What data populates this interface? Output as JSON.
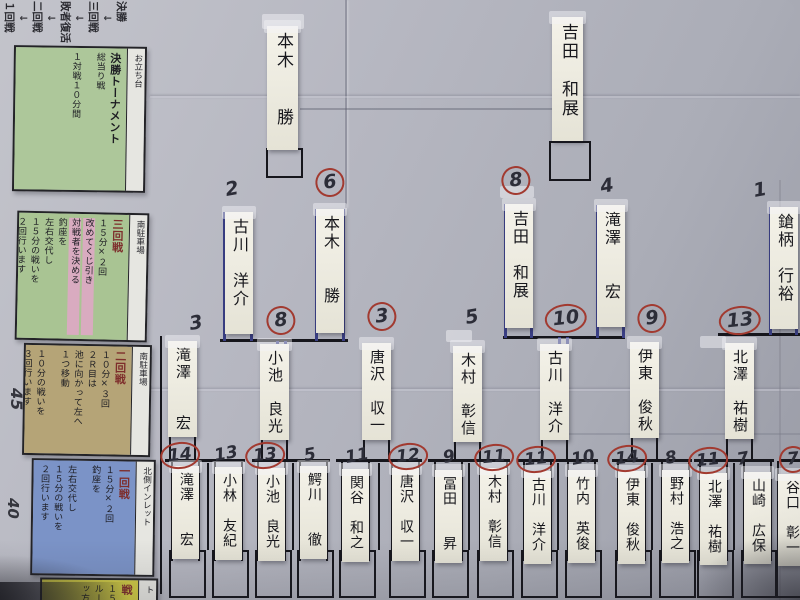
{
  "board": {
    "progression": [
      "１回戦",
      "↓",
      "二回戦",
      "↓",
      "敗者復活",
      "↓",
      "三回戦",
      "↓",
      "決勝"
    ],
    "margin": {
      "top_number": "45",
      "bottom_number": "40",
      "label": "基本進行"
    },
    "colors": {
      "riser_blue": "#3a3f85",
      "circle_red": "#a23a30",
      "legend_final": "#adc79a",
      "legend_round3": "#a9c493",
      "legend_round3_highlight": "#d9abc0",
      "legend_round2": "#b5a477",
      "legend_round1": "#7b93c7",
      "legend_bottom": "#cfca45"
    },
    "legend": [
      {
        "title": "決勝トーナメント",
        "lines": [
          "総当り戦",
          "",
          "１対戦１０分間"
        ],
        "location": "お立ち台",
        "color": "#adc79a",
        "highlight": []
      },
      {
        "title": "三回戦",
        "lines": [
          "１５分×２回",
          "改めてくじ引き",
          "対戦者を決める",
          "釣座を",
          "左右交代し",
          "１５分の戦いを",
          "２回行います"
        ],
        "location": "南駐車場",
        "color": "#a9c493",
        "highlight": [
          1,
          2
        ]
      },
      {
        "title": "二回戦",
        "lines": [
          "１０分×３回",
          "２Ｒ目は",
          "池に向かって左へ",
          "１つ移動",
          "",
          "１０分の戦いを",
          "３回行います"
        ],
        "location": "南駐車場",
        "color": "#b5a477",
        "highlight": []
      },
      {
        "title": "一回戦",
        "lines": [
          "１５分×２回",
          "釣座を",
          "",
          "左右交代し",
          "１５分の戦いを",
          "２回行います"
        ],
        "location": "北側インレット",
        "color": "#7b93c7",
        "highlight": []
      },
      {
        "title": "戦",
        "lines": [
          "１５分×２回",
          "ルー",
          "ッ方け"
        ],
        "location": "ト",
        "color": "#cfca45",
        "highlight": []
      }
    ],
    "rounds": {
      "final": [
        {
          "name": "本木　　勝"
        },
        {
          "name": "吉田　和展"
        }
      ],
      "semifinal": [
        {
          "name": "古川　洋介",
          "score": "2",
          "circled": false
        },
        {
          "name": "本木　　勝",
          "score": "6",
          "circled": true
        },
        {
          "name": "吉田　和展",
          "score": "8",
          "circled": true
        },
        {
          "name": "滝澤　　宏",
          "score": "4",
          "circled": false
        },
        {
          "name": "鎗柄　行裕",
          "score": "1",
          "circled": false
        }
      ],
      "quarterfinal": [
        {
          "name": "滝澤　　宏",
          "score": "3",
          "circled": false
        },
        {
          "name": "小池　良光",
          "score": "8",
          "circled": true
        },
        {
          "name": "唐沢　収一",
          "score": "3",
          "circled": true
        },
        {
          "name": "木村　彰信",
          "score": "5",
          "circled": false
        },
        {
          "name": "古川　洋介",
          "score": "10",
          "circled": true
        },
        {
          "name": "伊東　俊秋",
          "score": "9",
          "circled": true
        },
        {
          "name": "北澤　祐樹",
          "score": "13",
          "circled": true
        }
      ],
      "round1": [
        {
          "name": "滝澤　　宏",
          "score": "14",
          "circled": true
        },
        {
          "name": "小林　友紀",
          "score": "13",
          "circled": false
        },
        {
          "name": "小池　良光",
          "score": "13",
          "circled": true
        },
        {
          "name": "鰐川　　徹",
          "score": "5",
          "circled": false
        },
        {
          "name": "関谷　和之",
          "score": "11",
          "circled": false
        },
        {
          "name": "唐沢　収一",
          "score": "12",
          "circled": true
        },
        {
          "name": "冨田　　昇",
          "score": "9",
          "circled": false
        },
        {
          "name": "木村　彰信",
          "score": "11",
          "circled": true
        },
        {
          "name": "古川　洋介",
          "score": "11",
          "circled": true
        },
        {
          "name": "竹内　英俊",
          "score": "10",
          "circled": false
        },
        {
          "name": "伊東　俊秋",
          "score": "14",
          "circled": true
        },
        {
          "name": "野村　浩之",
          "score": "8",
          "circled": false
        },
        {
          "name": "北澤　祐樹",
          "score": "11",
          "circled": true
        },
        {
          "name": "山崎　広保",
          "score": "7",
          "circled": false
        },
        {
          "name": "谷口　彰一",
          "score": "7",
          "circled": true
        }
      ]
    }
  }
}
